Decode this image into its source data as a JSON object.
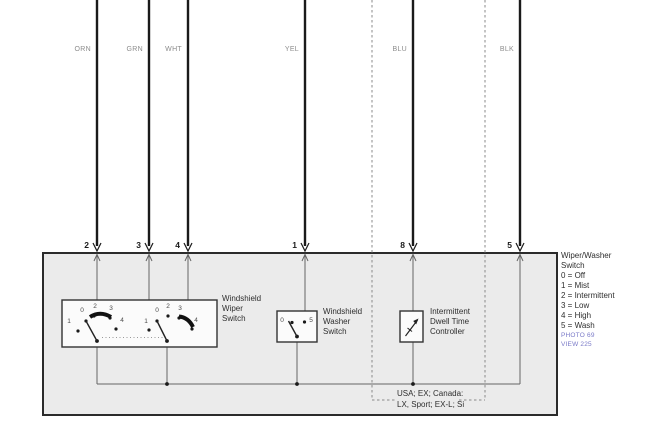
{
  "wires": [
    {
      "code": "ORN",
      "terminal": "2"
    },
    {
      "code": "GRN",
      "terminal": "3"
    },
    {
      "code": "WHT",
      "terminal": "4"
    },
    {
      "code": "YEL",
      "terminal": "1"
    },
    {
      "code": "BLU",
      "terminal": "8"
    },
    {
      "code": "BLK",
      "terminal": "5"
    }
  ],
  "components": {
    "wiper_switch": {
      "label_lines": [
        "Windshield",
        "Wiper",
        "Switch"
      ],
      "pole1_positions": [
        "1",
        "0",
        "2",
        "3",
        "4"
      ],
      "pole2_positions": [
        "1",
        "0",
        "2",
        "3",
        "4"
      ]
    },
    "washer_switch": {
      "label_lines": [
        "Windshield",
        "Washer",
        "Switch"
      ],
      "positions": [
        "0",
        "5"
      ]
    },
    "dwell_controller": {
      "label_lines": [
        "Intermittent",
        "Dwell Time",
        "Controller"
      ]
    }
  },
  "legend": {
    "title_lines": [
      "Wiper/Washer",
      "Switch"
    ],
    "entries": [
      "0 = Off",
      "1 = Mist",
      "2 = Intermittent",
      "3 = Low",
      "4 = High",
      "5 = Wash"
    ],
    "photo_ref": "PHOTO 69",
    "view_ref": "VIEW 225"
  },
  "caption_lines": [
    "USA; EX; Canada:",
    "LX, Sport; EX-L; Si"
  ],
  "colors": {
    "wire": "#1a1a1a",
    "thin_line": "#666666",
    "box_fill": "#ebebeb",
    "box_border": "#2b2b2b",
    "wire_label": "#8c8c8c",
    "text": "#2e2e2e",
    "reference_link": "#7a7ac8",
    "dashed_line": "#8a8a8a"
  }
}
